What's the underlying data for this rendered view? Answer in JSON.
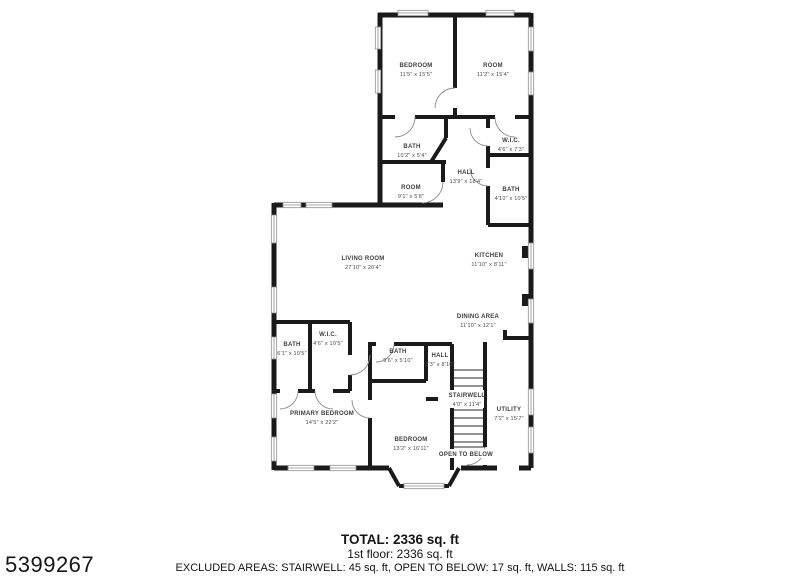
{
  "photo_id": "5399267",
  "footer": {
    "total": "TOTAL: 2336 sq. ft",
    "floor": "1st floor: 2336 sq. ft",
    "excluded": "EXCLUDED AREAS: STAIRWELL: 45 sq. ft, OPEN TO BELOW: 17 sq. ft, WALLS: 115 sq. ft"
  },
  "rooms": [
    {
      "name": "BEDROOM",
      "dims": "11'5\" x 15'5\""
    },
    {
      "name": "ROOM",
      "dims": "11'2\" x 15'4\""
    },
    {
      "name": "BATH",
      "dims": "10'2\" x 5'4\""
    },
    {
      "name": "W.I.C.",
      "dims": "4'6\" x 7'3\""
    },
    {
      "name": "ROOM",
      "dims": "9'1\" x 5'8\""
    },
    {
      "name": "HALL",
      "dims": "13'9\" x 18'4\""
    },
    {
      "name": "BATH",
      "dims": "4'10\" x 10'5\""
    },
    {
      "name": "KITCHEN",
      "dims": "11'10\" x 8'11\""
    },
    {
      "name": "LIVING ROOM",
      "dims": "27'10\" x 20'4\""
    },
    {
      "name": "DINING AREA",
      "dims": "11'10\" x 12'1\""
    },
    {
      "name": "W.I.C.",
      "dims": "4'6\" x 10'5\""
    },
    {
      "name": "BATH",
      "dims": "6'1\" x 10'5\""
    },
    {
      "name": "BATH",
      "dims": "9'6\" x 5'10\""
    },
    {
      "name": "HALL",
      "dims": "2'3\" x 8'10\""
    },
    {
      "name": "STAIRWELL",
      "dims": "4'0\" x 11'4\""
    },
    {
      "name": "UTILITY",
      "dims": "7'2\" x 15'7\""
    },
    {
      "name": "PRIMARY BEDROOM",
      "dims": "14'5\" x 22'2\""
    },
    {
      "name": "BEDROOM",
      "dims": "13'2\" x 16'11\""
    },
    {
      "name": "OPEN TO BELOW",
      "dims": ""
    }
  ],
  "colors": {
    "wall": "#1a1a1a",
    "label": "#3d3d3d",
    "window": "#8f8f8f"
  }
}
